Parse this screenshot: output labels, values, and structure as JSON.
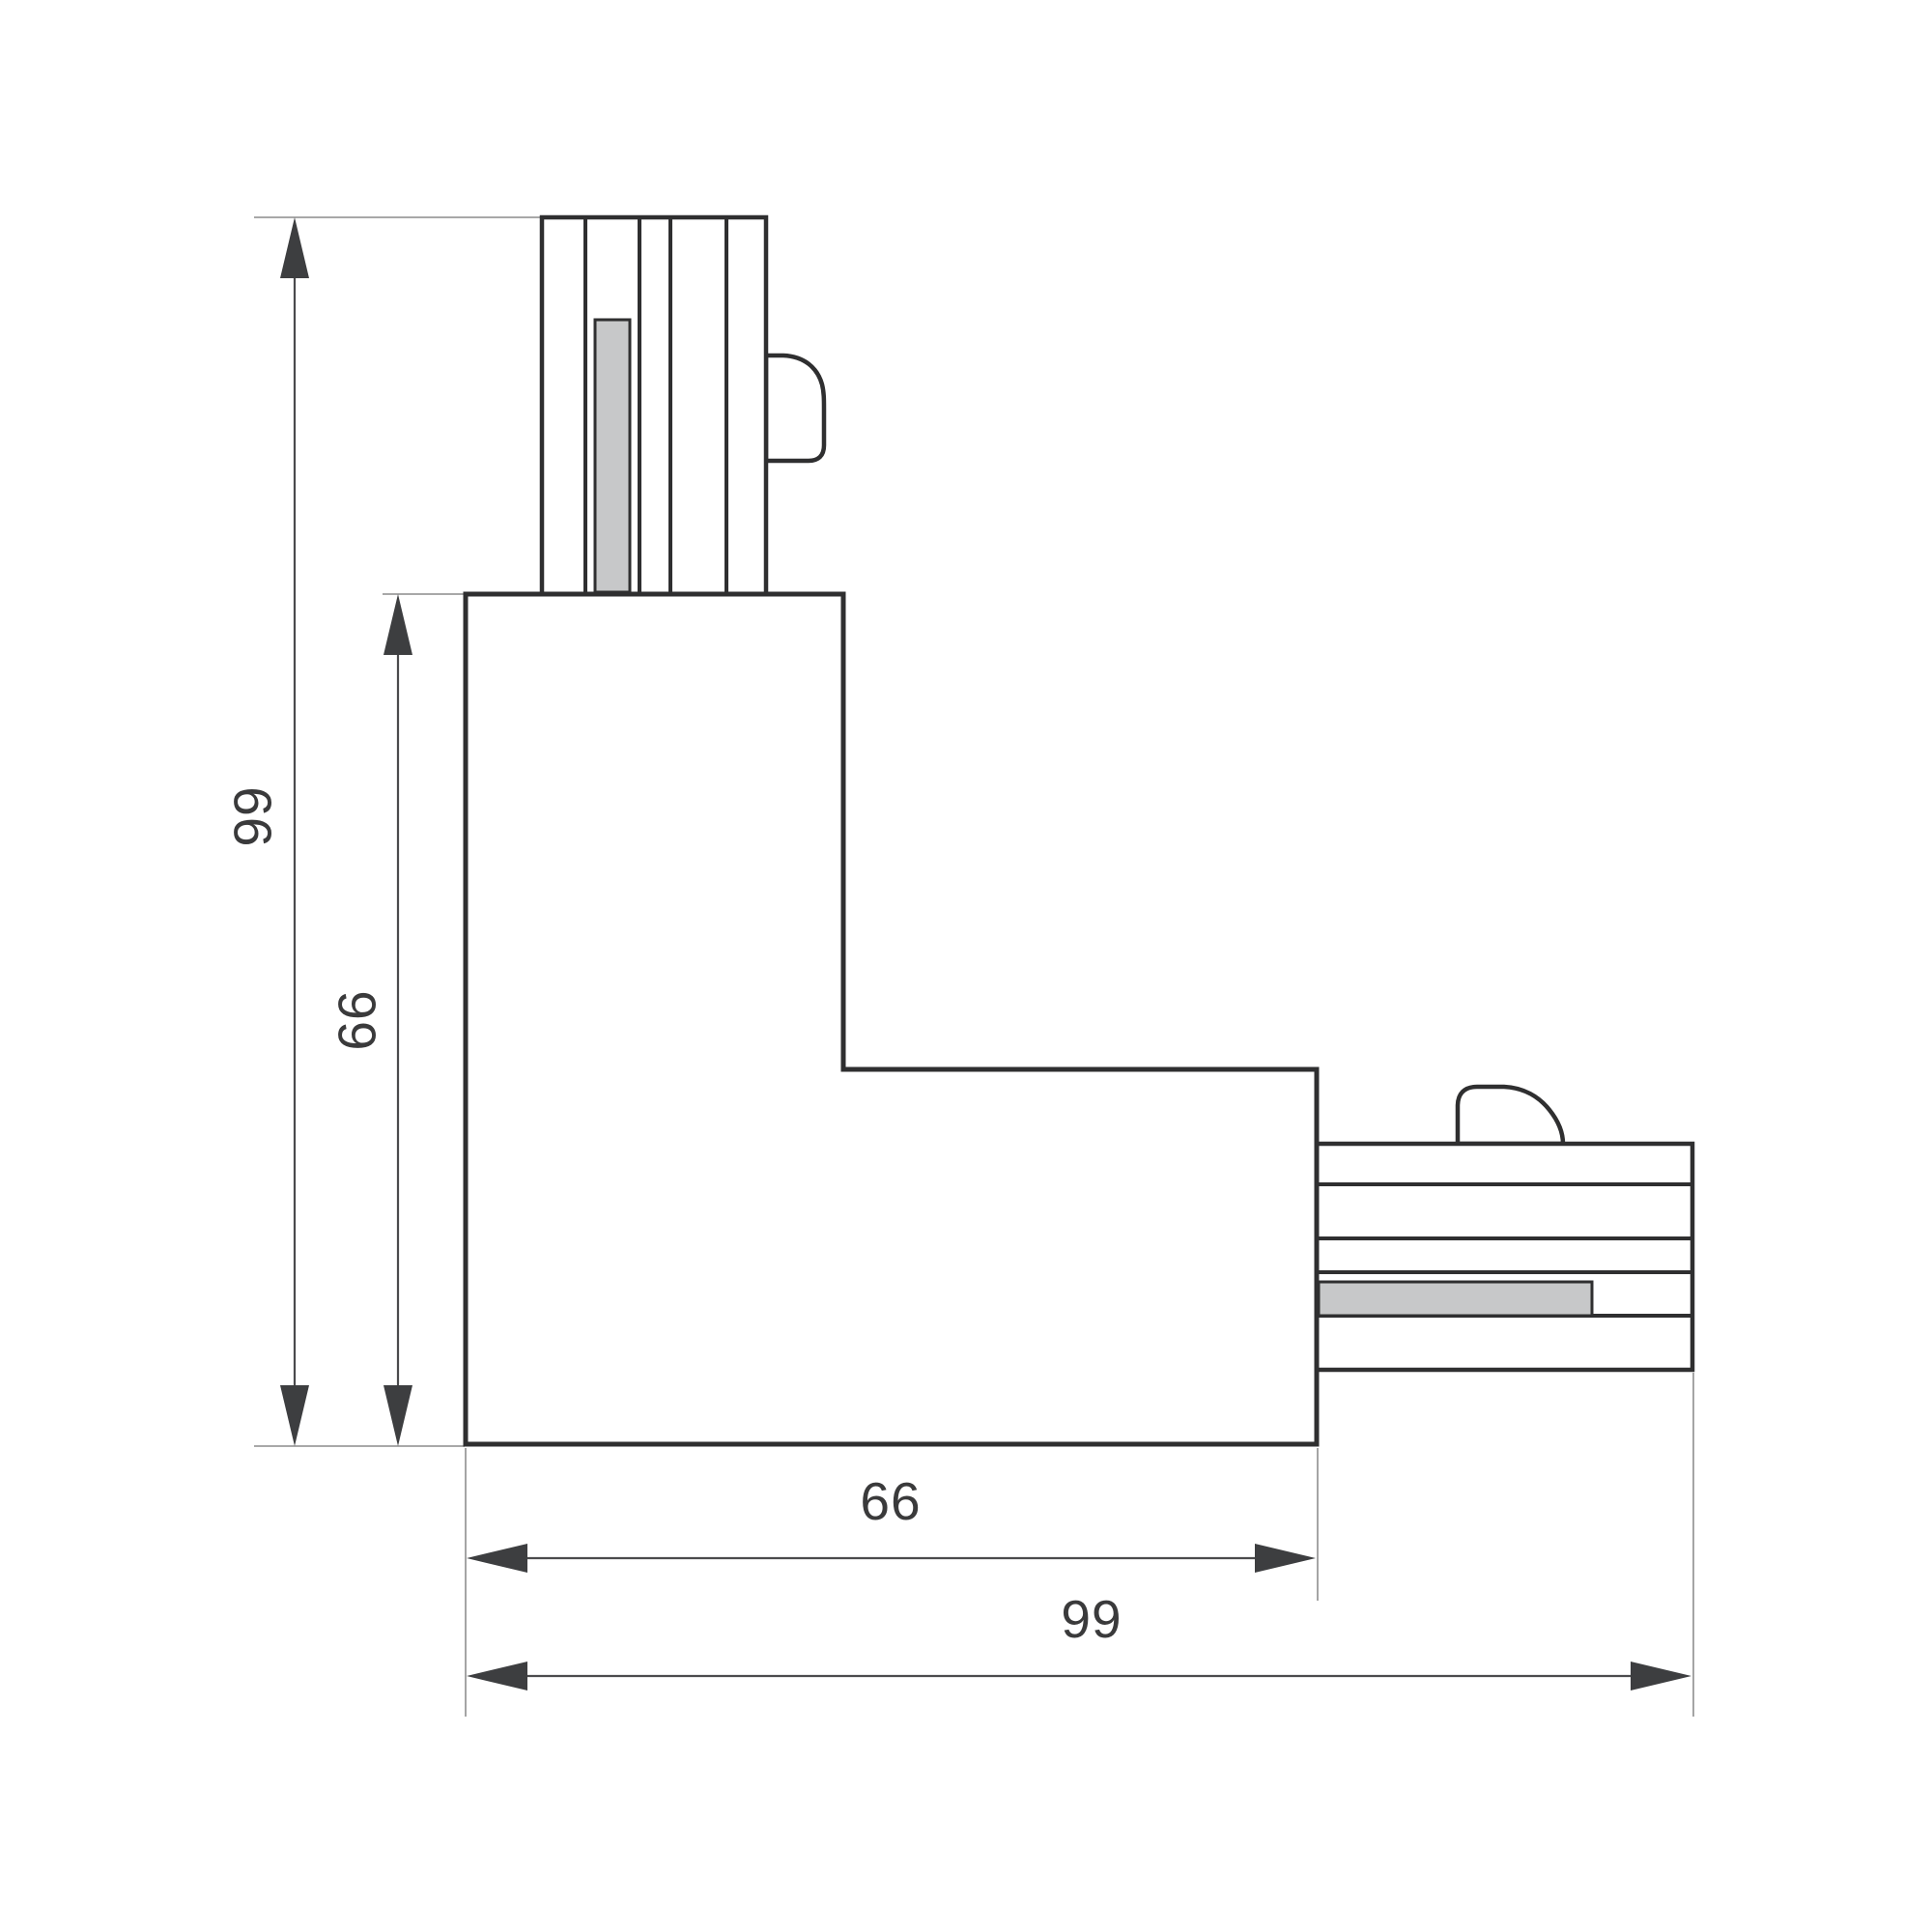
{
  "dimensions": {
    "overall_height": {
      "label": "99"
    },
    "body_height": {
      "label": "66"
    },
    "body_width": {
      "label": "66"
    },
    "overall_width": {
      "label": "99"
    }
  },
  "colors": {
    "background": "#ffffff",
    "outline": "#2f2f30",
    "stripe": "#2f2f30",
    "dim-line": "#4b4b4d",
    "ext-line": "#9b9b9b",
    "arrow": "#3d3e40",
    "contact": "#c7c8c9",
    "label": "#3a3a3b"
  }
}
